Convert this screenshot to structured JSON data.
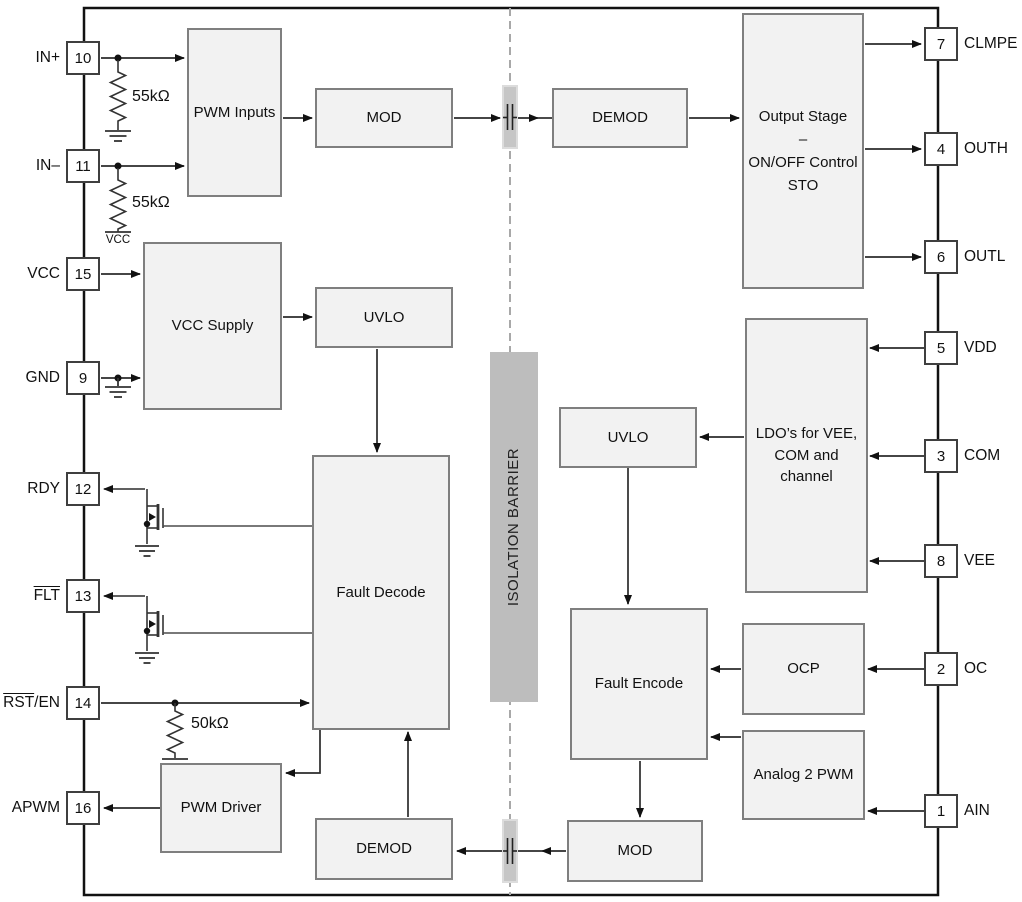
{
  "isolation_barrier_label": "ISOLATION BARRIER",
  "colors": {
    "block_fill": "#f2f2f2",
    "block_border": "#7f7f7f",
    "barrier_fill": "#bdbdbd",
    "dashed_line": "#a8a8a8",
    "wire": "#2b2b2b",
    "pin_box_border": "#3f3f3f"
  },
  "blocks": {
    "pwm_inputs": {
      "label": "PWM Inputs"
    },
    "mod_top": {
      "label": "MOD"
    },
    "demod_top": {
      "label": "DEMOD"
    },
    "output_stage": {
      "line1": "Output Stage",
      "line2": "–",
      "line3": "ON/OFF Control",
      "line4": "STO"
    },
    "vcc_supply": {
      "label": "VCC Supply"
    },
    "uvlo_left": {
      "label": "UVLO"
    },
    "fault_decode": {
      "label": "Fault Decode"
    },
    "uvlo_right": {
      "label": "UVLO"
    },
    "ldo": {
      "line1": "LDO’s for VEE,",
      "line2": "COM and channel"
    },
    "fault_encode": {
      "label": "Fault Encode"
    },
    "ocp": {
      "label": "OCP"
    },
    "analog_2_pwm": {
      "label": "Analog 2 PWM"
    },
    "pwm_driver": {
      "label": "PWM Driver"
    },
    "demod_bottom": {
      "label": "DEMOD"
    },
    "mod_bottom": {
      "label": "MOD"
    }
  },
  "pins_left": [
    {
      "number": "10",
      "label_over": "",
      "label_rest": "IN+"
    },
    {
      "number": "11",
      "label_over": "",
      "label_rest": "IN–"
    },
    {
      "number": "15",
      "label_over": "",
      "label_rest": "VCC"
    },
    {
      "number": "9",
      "label_over": "",
      "label_rest": "GND"
    },
    {
      "number": "12",
      "label_over": "",
      "label_rest": "RDY"
    },
    {
      "number": "13",
      "label_over": "FLT",
      "label_rest": ""
    },
    {
      "number": "14",
      "label_over": "RST",
      "label_rest": "/EN"
    },
    {
      "number": "16",
      "label_over": "",
      "label_rest": "APWM"
    }
  ],
  "pins_right": [
    {
      "number": "7",
      "label": "CLMPE"
    },
    {
      "number": "4",
      "label": "OUTH"
    },
    {
      "number": "6",
      "label": "OUTL"
    },
    {
      "number": "5",
      "label": "VDD"
    },
    {
      "number": "3",
      "label": "COM"
    },
    {
      "number": "8",
      "label": "VEE"
    },
    {
      "number": "2",
      "label": "OC"
    },
    {
      "number": "1",
      "label": "AIN"
    }
  ],
  "resistors": {
    "in_plus": {
      "value": "55kΩ"
    },
    "in_minus": {
      "value": "55kΩ"
    },
    "rst": {
      "value": "50kΩ"
    }
  },
  "labels": {
    "vcc_rail": "VCC"
  }
}
